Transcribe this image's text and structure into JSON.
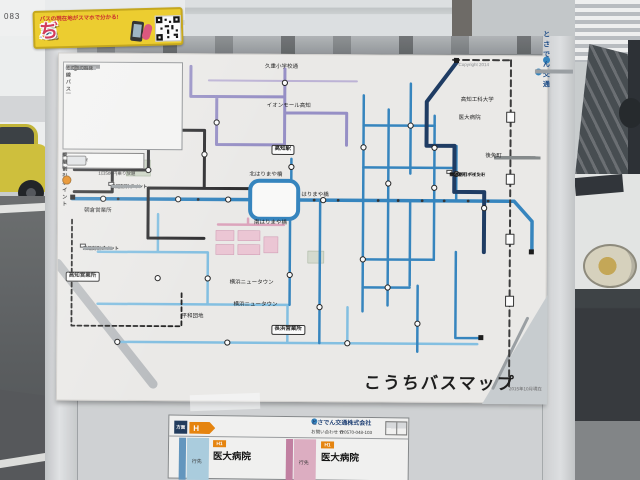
{
  "wall": {
    "sign_text": "083"
  },
  "sticker": {
    "tagline": "バスの現在地がスマホで分かる!",
    "title_chars": [
      "バ",
      "ス",
      "こ",
      "っ",
      "ち"
    ],
    "title_colors": [
      "#e0375a",
      "#2f7fd4",
      "#f08a1e",
      "#3fae4e",
      "#e0375a"
    ]
  },
  "poster": {
    "copyright": "Copyright 2014",
    "operator_logo": "とさでん交通",
    "title": "こうちバスマップ",
    "date_note": "2015年10月現在",
    "legend": {
      "col1_header": "路線バス",
      "col1_colors": [
        "#3c86c8",
        "#8f86c6",
        "#d998b4",
        "#23355c",
        "#69b0dc",
        "#1b2a4a",
        "#8a8f94"
      ],
      "col2_colors": [
        "#4a90d0",
        "#4a90d0",
        "#4a90d0",
        "#4a90d0"
      ],
      "airport_label": "空港連絡バス",
      "airport_color": "#1d3a5f",
      "myyu_label": "MY遊バス",
      "myyu_color": "#3f8fbf",
      "other_label": "その他の路線",
      "other_color": "#999999",
      "fare_label": "200円",
      "ic_label": "ICカード",
      "ic_note": "1日500円乗り放題",
      "transfer_label": "乗継割引ポイント"
    },
    "labels": [
      {
        "t": "高知駅",
        "x": 213,
        "y": 90,
        "box": 1
      },
      {
        "t": "北はりまや橋",
        "x": 191,
        "y": 118
      },
      {
        "t": "南はりまや橋",
        "x": 196,
        "y": 166
      },
      {
        "t": "はりまや橋",
        "x": 243,
        "y": 138
      },
      {
        "t": "イオンモール高知",
        "x": 208,
        "y": 49
      },
      {
        "t": "久重小学校通",
        "x": 206,
        "y": 10
      },
      {
        "t": "高知工科大学",
        "x": 402,
        "y": 42
      },
      {
        "t": "後免町",
        "x": 427,
        "y": 98
      },
      {
        "t": "医大病院",
        "x": 400,
        "y": 60
      },
      {
        "t": "朝倉営業所",
        "x": 26,
        "y": 155
      },
      {
        "t": "高知営業所",
        "x": 8,
        "y": 218,
        "box": 1
      },
      {
        "t": "長浜営業所",
        "x": 214,
        "y": 270,
        "box": 1
      },
      {
        "t": "横浜ニュータウン",
        "x": 172,
        "y": 226
      },
      {
        "t": "横浜ニュータウン",
        "x": 176,
        "y": 248
      },
      {
        "t": "平和団地",
        "x": 124,
        "y": 260
      }
    ],
    "callouts": [
      {
        "x": 50,
        "y": 128,
        "title": "乗継割引ポイント"
      },
      {
        "x": 22,
        "y": 190,
        "title": "乗継割引ポイント"
      },
      {
        "x": 388,
        "y": 114,
        "title": "乗継割引ポイント",
        "line2": "後免西町〜後免町"
      }
    ],
    "notes_lines": 16
  },
  "panel": {
    "direction_label": "方面",
    "route_letter": "H",
    "operator": "とさでん交通株式会社",
    "phone_label": "お問い合わせ",
    "phone_number": "0570-048-103",
    "columns": [
      {
        "dest_label": "行先",
        "route_no": "H1",
        "destination": "医大病院",
        "band": "#a9cfe2",
        "stripe": "#5e97c4"
      },
      {
        "dest_label": "行先",
        "route_no": "H1",
        "destination": "医大病院",
        "band": "#e2adc4",
        "stripe": "#c77fa4"
      }
    ]
  }
}
